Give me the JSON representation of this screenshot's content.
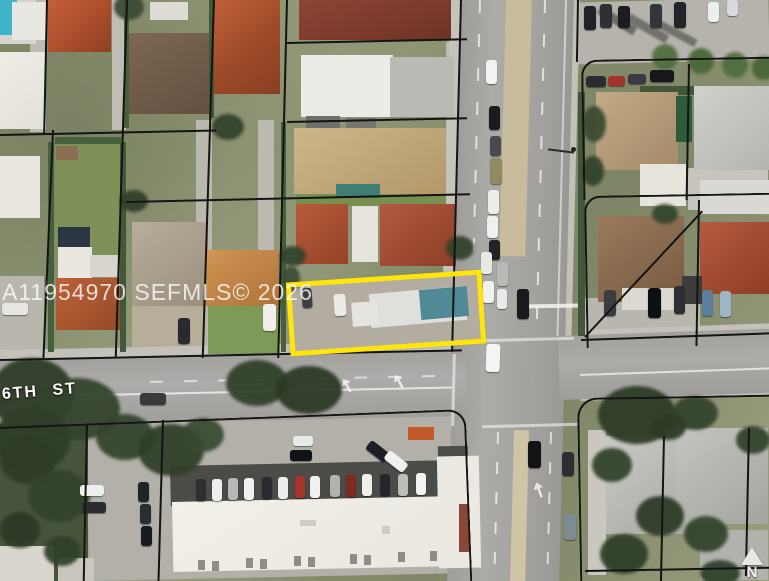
{
  "map": {
    "watermark": "A11954970 SEFMLS© 2026",
    "street_label": "6TH ST",
    "north_arrow_label": "N"
  },
  "colors": {
    "highlight": "#FFE50A",
    "parcel_line": "#141414",
    "watermark_text": "#FFFFFF",
    "road": "#A6A5A1",
    "median": "#C8BC9D",
    "grass": "#8F9674",
    "pool": "#3FB3C8"
  }
}
